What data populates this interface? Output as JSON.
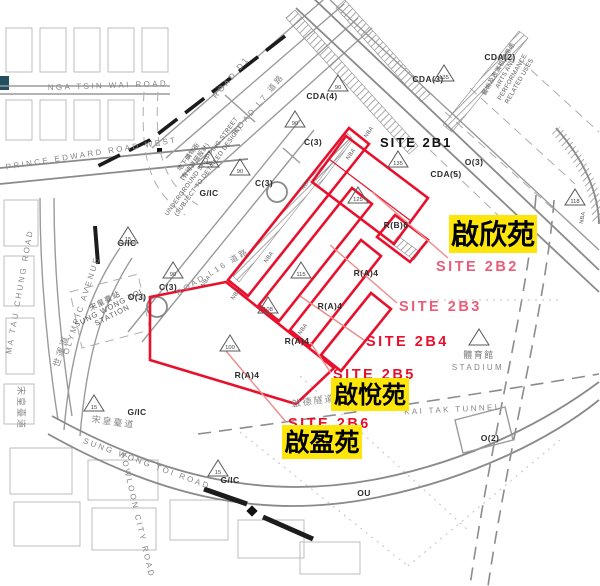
{
  "colors": {
    "site_outline": "#e8112d",
    "estate_highlight": "#ffe60a",
    "leader": "#f08a8a",
    "site_label_pink": "#ea5d78",
    "site_label_red": "#e8112d"
  },
  "site_labels": [
    {
      "name": "site-2b1-label",
      "text": "SITE 2B1",
      "x": 380,
      "y": 147,
      "cls": "lbl-site-black"
    },
    {
      "name": "site-2b2-label",
      "text": "SITE 2B2",
      "x": 436,
      "y": 271,
      "cls": "lbl-site-pink",
      "leader": [
        448,
        258,
        372,
        192
      ]
    },
    {
      "name": "site-2b3-label",
      "text": "SITE 2B3",
      "x": 399,
      "y": 311,
      "cls": "lbl-site-pink",
      "leader": [
        397,
        303,
        330,
        245
      ]
    },
    {
      "name": "site-2b4-label",
      "text": "SITE 2B4",
      "x": 366,
      "y": 346,
      "cls": "lbl-site-red",
      "leader": [
        364,
        340,
        300,
        296
      ]
    },
    {
      "name": "site-2b5-label",
      "text": "SITE 2B5",
      "x": 333,
      "y": 379,
      "cls": "lbl-site-red",
      "leader": [
        331,
        373,
        310,
        342
      ]
    },
    {
      "name": "site-2b6-label",
      "text": "SITE 2B6",
      "x": 288,
      "y": 428,
      "cls": "lbl-site-red",
      "leader": [
        286,
        422,
        226,
        351
      ]
    }
  ],
  "estates": [
    {
      "name": "estate-kai-yan",
      "text": "啟欣苑",
      "x": 449,
      "y": 215,
      "w": 88,
      "h": 38,
      "fs": 28
    },
    {
      "name": "estate-kai-yuet",
      "text": "啟悅苑",
      "x": 331,
      "y": 378,
      "w": 78,
      "h": 33,
      "fs": 24
    },
    {
      "name": "estate-kai-ying",
      "text": "啟盈苑",
      "x": 282,
      "y": 425,
      "w": 80,
      "h": 34,
      "fs": 25
    }
  ],
  "zones": [
    {
      "text": "CDA(2)",
      "x": 500,
      "y": 60
    },
    {
      "text": "CDA(3)",
      "x": 428,
      "y": 82
    },
    {
      "text": "CDA(4)",
      "x": 322,
      "y": 99
    },
    {
      "text": "CDA(5)",
      "x": 446,
      "y": 177
    },
    {
      "text": "O(3)",
      "x": 474,
      "y": 165
    },
    {
      "text": "O(3)",
      "x": 137,
      "y": 300
    },
    {
      "text": "O(2)",
      "x": 490,
      "y": 441
    },
    {
      "text": "OU",
      "x": 364,
      "y": 496
    },
    {
      "text": "R(B)6",
      "x": 396,
      "y": 228
    },
    {
      "text": "R(A)4",
      "x": 366,
      "y": 276
    },
    {
      "text": "R(A)4",
      "x": 330,
      "y": 309
    },
    {
      "text": "R(A)4",
      "x": 297,
      "y": 344
    },
    {
      "text": "R(A)4",
      "x": 247,
      "y": 378
    },
    {
      "text": "C(3)",
      "x": 313,
      "y": 145
    },
    {
      "text": "C(3)",
      "x": 264,
      "y": 186
    },
    {
      "text": "C(3)",
      "x": 168,
      "y": 290
    },
    {
      "text": "G/IC",
      "x": 209,
      "y": 196
    },
    {
      "text": "G/IC",
      "x": 127,
      "y": 246
    },
    {
      "text": "G/IC",
      "x": 137,
      "y": 415
    },
    {
      "text": "G/IC",
      "x": 230,
      "y": 483
    }
  ],
  "roads": [
    {
      "text": "NGA TSIN WAI ROAD",
      "x": 108,
      "y": 88,
      "rot": -2,
      "cls": "lbl-road"
    },
    {
      "text": "PRINCE EDWARD ROAD WEST",
      "x": 92,
      "y": 156,
      "rot": -9,
      "cls": "lbl-road"
    },
    {
      "text": "MA TAU CHUNG ROAD",
      "x": 22,
      "y": 292,
      "rot": -80,
      "cls": "lbl-road"
    },
    {
      "text": "OLYMPIC AVENUE",
      "x": 84,
      "y": 306,
      "rot": -72,
      "cls": "lbl-road"
    },
    {
      "text": "世運道",
      "x": 64,
      "y": 352,
      "rot": -72,
      "cls": "lbl-road-cn"
    },
    {
      "text": "ROAD D1",
      "x": 233,
      "y": 79,
      "rot": -50,
      "cls": "lbl-road"
    },
    {
      "text": "ROAD L7 道路",
      "x": 260,
      "y": 106,
      "rot": -50,
      "cls": "lbl-road"
    },
    {
      "text": "ROAD L16 道路",
      "x": 214,
      "y": 274,
      "rot": -31,
      "cls": "lbl-road"
    },
    {
      "text": "SUNG WONG TOI ROAD",
      "x": 146,
      "y": 466,
      "rot": 20,
      "cls": "lbl-road"
    },
    {
      "text": "宋皇臺道",
      "x": 113,
      "y": 425,
      "rot": 8,
      "cls": "lbl-road-cn"
    },
    {
      "text": "宋皇臺道",
      "x": 18,
      "y": 408,
      "rot": 90,
      "cls": "lbl-road-cn"
    },
    {
      "text": "KOWLOON CITY ROAD",
      "x": 135,
      "y": 516,
      "rot": 77,
      "cls": "lbl-road"
    },
    {
      "text": "KAI TAK TUNNEL",
      "x": 453,
      "y": 412,
      "rot": -3,
      "cls": "lbl-road"
    },
    {
      "text": "啟德隧道",
      "x": 314,
      "y": 404,
      "rot": -8,
      "cls": "lbl-road-cn"
    },
    {
      "text": "體育館",
      "x": 479,
      "y": 358,
      "rot": 0,
      "cls": "lbl-place"
    },
    {
      "text": "STADIUM",
      "x": 478,
      "y": 370,
      "rot": 0,
      "cls": "lbl-road"
    }
  ],
  "station": {
    "name": "sung-wong-toi-station-label",
    "lines": [
      "宋皇臺站",
      "SUNG WONG TOI",
      "STATION"
    ],
    "x": 106,
    "y": 303,
    "rot": -27
  },
  "notes": [
    {
      "name": "underground-shopping-street-note",
      "lines": [
        "地下購物街",
        "(有待詳細設計)",
        "UNDERGROUND SHOPPING STREET",
        "(SUBJECT TO DETAILED DESIGN)"
      ],
      "x": 190,
      "y": 158,
      "rot": -54
    },
    {
      "name": "arts-performance-note",
      "lines": [
        "藝術及表演相關用途",
        "ARTS AND",
        "PERFORMANCE",
        "RELATED USES"
      ],
      "x": 500,
      "y": 70,
      "rot": -60
    }
  ],
  "nba_labels": [
    {
      "x": 370,
      "y": 133,
      "rot": -55
    },
    {
      "x": 352,
      "y": 155,
      "rot": -55
    },
    {
      "x": 307,
      "y": 185,
      "rot": -55
    },
    {
      "x": 270,
      "y": 258,
      "rot": -55
    },
    {
      "x": 207,
      "y": 282,
      "rot": -55
    },
    {
      "x": 237,
      "y": 295,
      "rot": -55
    },
    {
      "x": 304,
      "y": 330,
      "rot": -55
    },
    {
      "x": 584,
      "y": 218,
      "rot": -80
    }
  ],
  "height_markers": [
    {
      "v": "135",
      "x": 398,
      "y": 160
    },
    {
      "v": "125",
      "x": 358,
      "y": 196
    },
    {
      "v": "115",
      "x": 301,
      "y": 271
    },
    {
      "v": "108",
      "x": 268,
      "y": 306
    },
    {
      "v": "100",
      "x": 230,
      "y": 344
    },
    {
      "v": "135",
      "x": 444,
      "y": 74
    },
    {
      "v": "118",
      "x": 575,
      "y": 198
    },
    {
      "v": "90",
      "x": 338,
      "y": 84
    },
    {
      "v": "90",
      "x": 295,
      "y": 120
    },
    {
      "v": "45",
      "x": 209,
      "y": 160
    },
    {
      "v": "90",
      "x": 240,
      "y": 168
    },
    {
      "v": "90",
      "x": 173,
      "y": 271
    },
    {
      "v": "15",
      "x": 128,
      "y": 236
    },
    {
      "v": "15",
      "x": 94,
      "y": 404
    },
    {
      "v": "15",
      "x": 218,
      "y": 469
    },
    {
      "v": "",
      "x": 479,
      "y": 338
    }
  ]
}
